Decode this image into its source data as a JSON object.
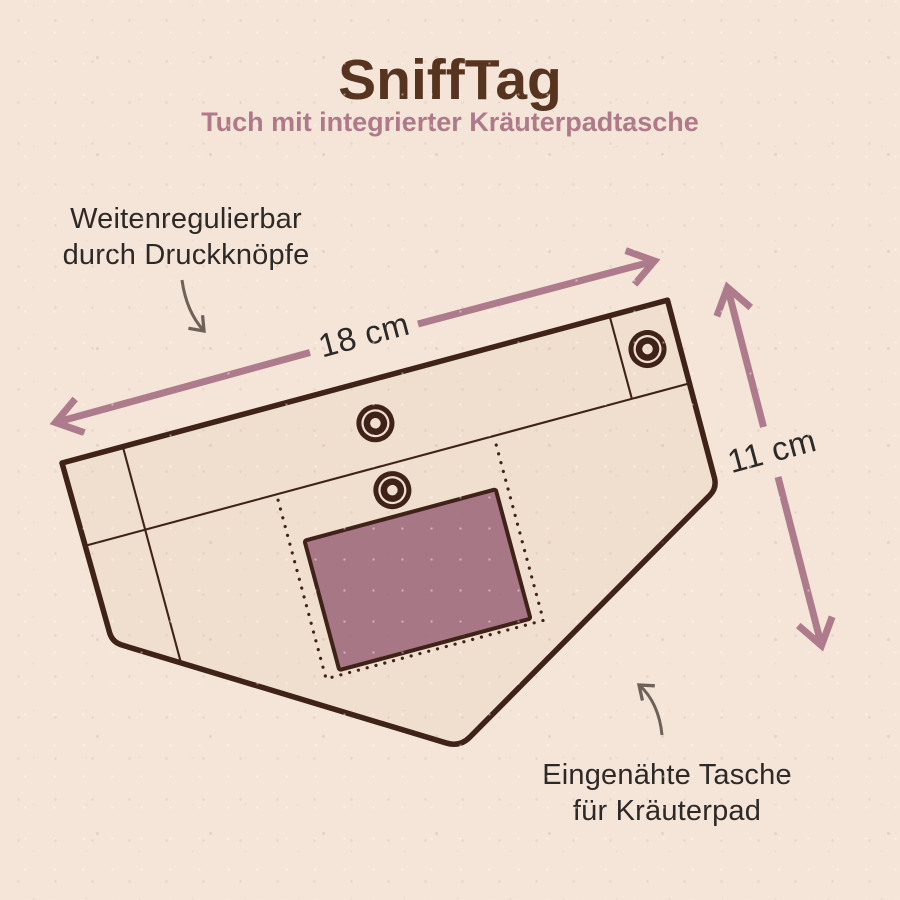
{
  "title": "SniffTag",
  "subtitle": "Tuch mit integrierter Kräuterpadtasche",
  "labels": {
    "snap_adjustable": "Weitenregulierbar\ndurch Druckknöpfe",
    "sewn_pocket": "Eingenähte Tasche\nfür Kräuterpad"
  },
  "dimensions": {
    "width": "18 cm",
    "height": "11 cm"
  },
  "diagram": {
    "subject": "bandana-cloth",
    "snap_button_count": 3,
    "pocket": "herb-pad-pocket"
  },
  "colors": {
    "background": "#f5e4d8",
    "cloth_fill": "#f0dfcf",
    "outline_brown": "#3f2318",
    "title_brown": "#573420",
    "accent_mauve": "#ae7a8a",
    "pocket_mauve": "#a87786",
    "dim_arrow_mauve": "#ad7b8b",
    "label_text": "#2d2926",
    "note_arrow_gray": "#6e6158"
  }
}
